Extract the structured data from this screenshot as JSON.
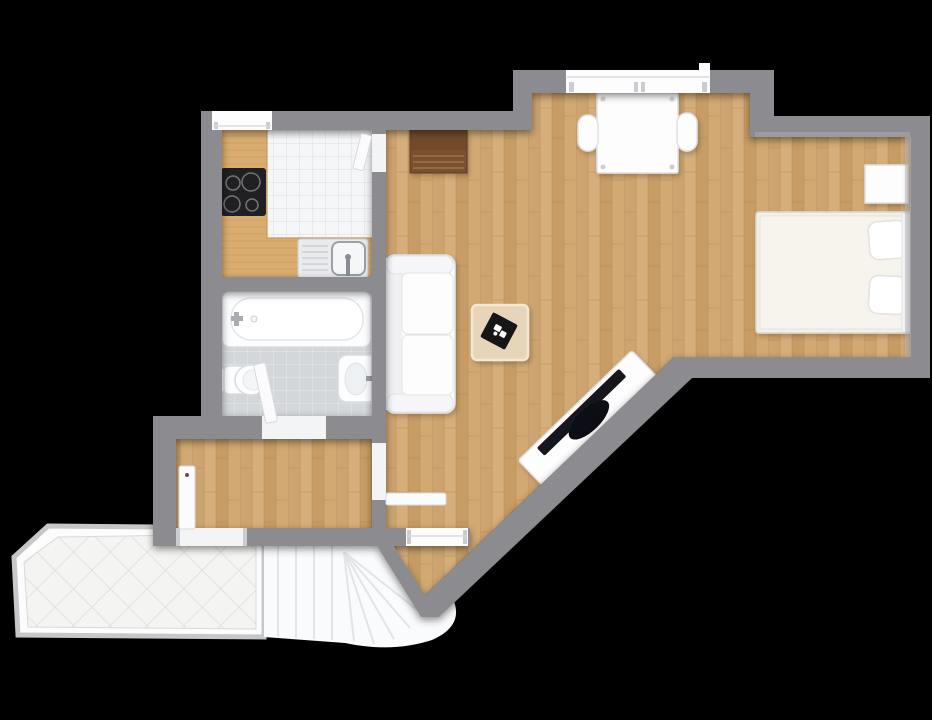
{
  "scene": {
    "type": "floor-plan",
    "view": "top-down-3d-render",
    "background": "#000000",
    "apartment": "studio-with-terrace-and-stairwell"
  },
  "palette": {
    "background": "#000000",
    "wall": "#8c8c90",
    "wallEdge": "#7a7a7e",
    "wallLight": "#b4b4b8",
    "woodA": "#cda46f",
    "woodB": "#d6ae7c",
    "woodC": "#c79d65",
    "woodD": "#d2a973",
    "woodSeam": "#a9824f",
    "counterBase": "#d9ac70",
    "counterSeam": "#c29354",
    "kitchenTile": "#f5f6f8",
    "kitchenGrout": "#dcdfe2",
    "bathTile": "#d3d7d9",
    "bathGrout": "#e7eaec",
    "terraceTile": "#f4f5f2",
    "terraceGrout": "#d6d9d6",
    "terraceRail": "#c6c7c9",
    "terraceMargin": "#fbfcfb",
    "stairTread": "#fafbfc",
    "stairLine": "#e2e4e7",
    "fixtureFill": "#fcfdfe",
    "fixtureStroke": "#d9dcdf",
    "fixtureInner": "#eef1f3",
    "applianceDark": "#202023",
    "burnerRing": "#74747a",
    "steel": "#e9ebed",
    "steelDark": "#9aa1a7",
    "tableWood": "#e6d5b8",
    "tableWoodEdge": "#f2e8d6",
    "trayBlack": "#181819",
    "furnitureFill": "#fdfdfe",
    "furnitureStroke": "#e2e2e6",
    "cushion": "#f1f1f4",
    "duvet": "#f6f4ed",
    "bedFrame": "#f1efe9",
    "brownWood": "#79512f",
    "brownWoodDark": "#5c3c20",
    "brownSlat": "#956b42",
    "threshold": "#f3f4f6",
    "windowWhite": "#fdfdfe",
    "windowFrame": "#c9ccd0",
    "doorLeaf": "#fbfbfd",
    "doorLeafStroke": "#d8d8db",
    "handleDark": "#55565a"
  },
  "rooms": [
    {
      "name": "kitchen",
      "floor": "white-tile-with-wood-counter"
    },
    {
      "name": "bathroom",
      "floor": "grey-tile"
    },
    {
      "name": "hallway",
      "floor": "wood-parquet"
    },
    {
      "name": "living-dining-area",
      "floor": "wood-parquet"
    },
    {
      "name": "sleeping-area",
      "floor": "wood-parquet"
    },
    {
      "name": "terrace-landing",
      "floor": "white-diagonal-tile"
    },
    {
      "name": "stairwell",
      "floor": "white-winder-stairs"
    }
  ],
  "fixtures": [
    "cooktop-4-burners",
    "kitchen-sink-with-drainboard",
    "kitchen-counter-l-shape",
    "bathtub",
    "wash-basin",
    "wall-hung-toilet"
  ],
  "furniture": [
    "two-seat-sofa",
    "coffee-table-with-black-tray",
    "diagonal-tv-board-with-tv",
    "dining-table",
    "dining-chair-left",
    "dining-chair-right",
    "dark-wood-sideboard",
    "double-bed",
    "pillow-upper",
    "pillow-lower",
    "nightstand"
  ],
  "openings": {
    "windows": [
      "kitchen-window",
      "living-room-window",
      "stair-side-window"
    ],
    "doors": [
      "entrance-door-open",
      "bathroom-door-ajar",
      "hallway-living-door-open",
      "kitchen-doorway"
    ]
  },
  "stairs": {
    "straight_treads": 5,
    "winder_treads": 6,
    "shape": "quarter-turn"
  }
}
